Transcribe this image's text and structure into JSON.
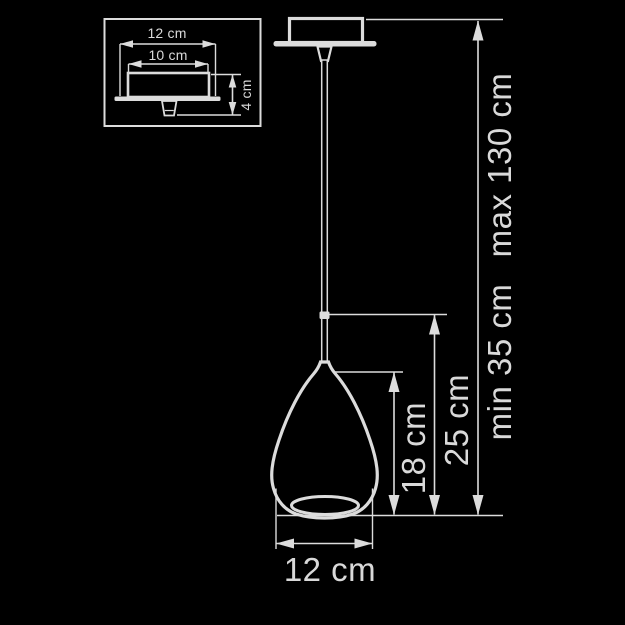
{
  "colors": {
    "background": "#000000",
    "line": "#dcdcdc",
    "text": "#d9d9d9"
  },
  "inset": {
    "plate_width": "12 cm",
    "body_width": "10 cm",
    "body_height": "4 cm"
  },
  "pendant": {
    "shade_diameter": "12 cm",
    "shade_height": "18 cm",
    "shade_with_rod_height": "25 cm",
    "suspension_min": "min 35 cm",
    "suspension_max": "max 130 cm"
  }
}
